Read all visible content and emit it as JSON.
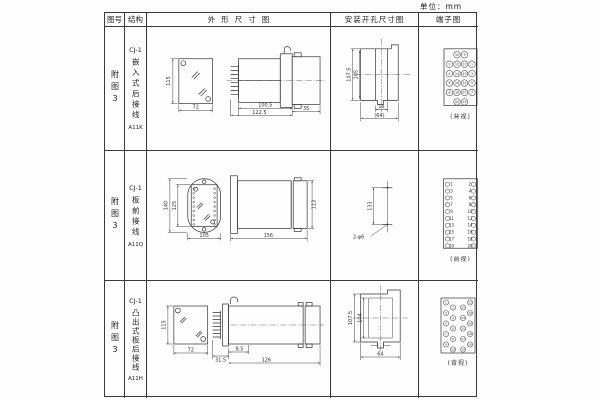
{
  "unit_label": "单位：mm",
  "header": {
    "col_fig": "图号",
    "col_struct": "结构",
    "col_outline": "外形尺寸图",
    "col_mounting": "安装开孔尺寸图",
    "col_terminal": "端子图"
  },
  "rows": [
    {
      "fig": "附图3",
      "model": "CJ-1",
      "structure": "嵌入式后接线",
      "code": "A11K",
      "outline": {
        "front_height": "115",
        "front_width": "72",
        "dim_body": "100.5",
        "dim_total": "122.5",
        "dim_rear": "35"
      },
      "mounting": {
        "outer": "107.5",
        "inner": "105",
        "slot": "16",
        "total": "(64)"
      },
      "terminal": {
        "view": "(背视)"
      }
    },
    {
      "fig": "附图3",
      "model": "CJ-1",
      "structure": "板前接线",
      "code": "A11Q",
      "outline": {
        "outer_height": "140",
        "inner_height": "125",
        "width": "105",
        "length": "156",
        "height": "113"
      },
      "mounting": {
        "distance": "133",
        "holes": "2-φ6"
      },
      "terminal": {
        "view": "(前视)"
      }
    },
    {
      "fig": "附图3",
      "model": "CJ-1",
      "structure": "凸出式板后接线",
      "code": "A11H",
      "outline": {
        "front_height": "115",
        "front_width": "72",
        "pins": "31.5",
        "front": "9.5",
        "total": "126"
      },
      "mounting": {
        "outer": "107.5",
        "inner": "104",
        "width": "64"
      },
      "terminal": {
        "view": "(背视)"
      }
    }
  ],
  "terminal_numbers": {
    "r1": [
      [
        "10",
        "9"
      ],
      [
        "2",
        "12",
        "11",
        "1"
      ],
      [
        "4",
        "14",
        "13",
        "3"
      ],
      [
        "6",
        "16",
        "15",
        "5"
      ],
      [
        "8",
        "18",
        "17",
        "7"
      ],
      [
        "20",
        "19"
      ]
    ],
    "r2_odd": [
      "1",
      "3",
      "5",
      "7",
      "9",
      "11",
      "13",
      "15",
      "17",
      "19"
    ],
    "r2_even": [
      "2",
      "4",
      "6",
      "8",
      "10",
      "12",
      "14",
      "16",
      "18",
      "20"
    ],
    "r3": {
      "left_outer": [
        "1",
        "3",
        "5",
        "7",
        "9"
      ],
      "left_inner": [
        "2",
        "4",
        "6",
        "8",
        "10"
      ],
      "right_inner": [
        "11",
        "13",
        "15",
        "17",
        "19"
      ],
      "right_outer": [
        "12",
        "14",
        "16",
        "18",
        "20"
      ]
    }
  }
}
